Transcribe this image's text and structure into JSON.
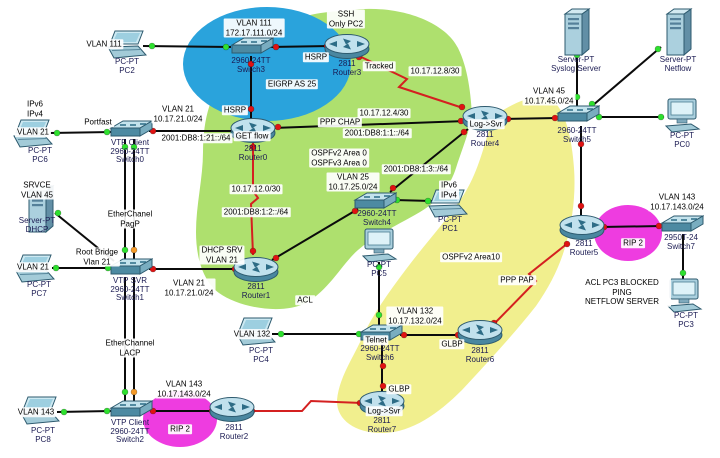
{
  "app": {
    "name": "network-topology-canvas"
  },
  "colors": {
    "black": "#0b0b0b",
    "red": "#d42020",
    "dot_green": "#2ee02e",
    "dot_red": "#e01212",
    "dot_orange": "#f59a28",
    "zone_green": "#aee06e",
    "zone_yellow": "#f1ef8e",
    "zone_blue": "#2aa3dc",
    "zone_magenta": "#ee3ce0"
  },
  "zones": [
    {
      "name": "ospf-green-region",
      "shape": "path",
      "color": "zone_green",
      "path": "M350 10 C400 4 445 22 458 48 C468 68 471 95 472 116 C468 136 461 152 456 168 C451 184 440 200 420 212 C398 225 375 235 358 250 C342 264 330 289 306 303 C282 315 240 308 219 293 C203 281 196 258 196 232 C196 205 203 178 203 152 C203 128 207 104 219 86 C231 66 258 38 290 22 C310 12 332 12 350 10 Z"
    },
    {
      "name": "ospf-area10-yellow-region",
      "shape": "path",
      "color": "zone_yellow",
      "path": "M500 112 C522 98 544 92 554 102 C566 112 572 140 574 168 C576 196 572 222 566 244 C560 266 550 286 536 306 C514 334 488 362 462 390 C438 414 412 432 384 433 C356 434 336 420 337 400 C339 378 352 360 363 336 C373 314 389 292 407 268 C425 244 447 220 463 196 C477 174 483 150 489 130 C493 118 496 114 500 112 Z"
    },
    {
      "name": "eigrp-blue-ellipse",
      "shape": "ellipse",
      "color": "zone_blue",
      "cx": 267,
      "cy": 64,
      "rx": 84,
      "ry": 57
    },
    {
      "name": "rip-magenta-ellipse-right",
      "shape": "ellipse",
      "color": "zone_magenta",
      "cx": 628,
      "cy": 233,
      "rx": 34,
      "ry": 28
    },
    {
      "name": "rip-magenta-ellipse-bottom",
      "shape": "ellipse",
      "color": "zone_magenta",
      "cx": 180,
      "cy": 419,
      "rx": 37,
      "ry": 28
    }
  ],
  "nodes": [
    {
      "id": "pc2",
      "type": "laptop",
      "x": 127,
      "y": 45,
      "ly": 58,
      "label": "PC-PT\nPC2"
    },
    {
      "id": "switch3",
      "type": "switch",
      "x": 251,
      "y": 47,
      "ly": 57,
      "label": "2960-24TT\nSwitch3"
    },
    {
      "id": "router3",
      "type": "router",
      "x": 347,
      "y": 47,
      "ly": 60,
      "label": "2811\nRouter3"
    },
    {
      "id": "syslog-server",
      "type": "server",
      "x": 576,
      "y": 32,
      "ly": 56,
      "label": "Server-PT\nSyslog Server"
    },
    {
      "id": "netflow-server",
      "type": "server",
      "x": 678,
      "y": 32,
      "ly": 56,
      "label": "Server-PT\nNetflow"
    },
    {
      "id": "pc6",
      "type": "laptop",
      "x": 33,
      "y": 134,
      "lx": 40,
      "ly": 147,
      "label": "PC-PT\nPC6"
    },
    {
      "id": "switch0",
      "type": "switch",
      "x": 130,
      "y": 130,
      "ly": 139,
      "label": "VTP Client\n2960-24TT\nSwitch0"
    },
    {
      "id": "router0",
      "type": "router",
      "x": 253,
      "y": 131,
      "ly": 145,
      "label": "2811\nRouter0"
    },
    {
      "id": "router4",
      "type": "router",
      "x": 485,
      "y": 119,
      "ly": 131,
      "label": "2811\nRouter4"
    },
    {
      "id": "switch5",
      "type": "switch",
      "x": 577,
      "y": 115,
      "ly": 127,
      "label": "2960-24TT\nSwitch5"
    },
    {
      "id": "pc0",
      "type": "desktop",
      "x": 682,
      "y": 116,
      "ly": 132,
      "label": "PC-PT\nPC0"
    },
    {
      "id": "dhcp-server",
      "type": "server",
      "x": 40,
      "y": 209,
      "lx": 37,
      "ly": 217,
      "label": "Server-PT\nDHCP"
    },
    {
      "id": "switch1",
      "type": "switch",
      "x": 130,
      "y": 268,
      "ly": 277,
      "label": "VTP SVR\n2960-24TT\nSwitch1"
    },
    {
      "id": "pc7",
      "type": "laptop",
      "x": 35,
      "y": 269,
      "lx": 39,
      "ly": 281,
      "label": "PC-PT\nPC7"
    },
    {
      "id": "router1",
      "type": "router",
      "x": 256,
      "y": 270,
      "ly": 283,
      "label": "2811\nRouter1"
    },
    {
      "id": "switch4",
      "type": "switch",
      "x": 374,
      "y": 202,
      "lx": 377,
      "ly": 210,
      "label": "2960-24TT\nSwitch4"
    },
    {
      "id": "pc1",
      "type": "laptop",
      "x": 448,
      "y": 204,
      "lx": 450,
      "ly": 216,
      "label": "PC-PT\nPC1"
    },
    {
      "id": "pc5",
      "type": "desktop",
      "x": 379,
      "y": 246,
      "ly": 261,
      "label": "PC-PT\nPC5"
    },
    {
      "id": "router5",
      "type": "router",
      "x": 582,
      "y": 228,
      "lx": 584,
      "ly": 240,
      "label": "2811\nRouter5"
    },
    {
      "id": "switch7",
      "type": "switch",
      "x": 681,
      "y": 225,
      "ly": 234,
      "label": "2950T-24\nSwitch7"
    },
    {
      "id": "pc3",
      "type": "desktop",
      "x": 684,
      "y": 296,
      "lx": 686,
      "ly": 312,
      "label": "PC-PT\nPC3"
    },
    {
      "id": "switch6",
      "type": "switch",
      "x": 380,
      "y": 334,
      "ly": 345,
      "label": "2960-24TT\nSwitch6"
    },
    {
      "id": "router6",
      "type": "router",
      "x": 480,
      "y": 333,
      "ly": 347,
      "label": "2811\nRouter6"
    },
    {
      "id": "pc4",
      "type": "laptop",
      "x": 256,
      "y": 332,
      "lx": 261,
      "ly": 347,
      "label": "PC-PT\nPC4"
    },
    {
      "id": "router7",
      "type": "router",
      "x": 382,
      "y": 404,
      "ly": 417,
      "label": "2811\nRouter7"
    },
    {
      "id": "switch2",
      "type": "switch",
      "x": 130,
      "y": 410,
      "ly": 419,
      "label": "VTP Client\n2960-24TT\nSwitch2"
    },
    {
      "id": "pc8",
      "type": "laptop",
      "x": 40,
      "y": 411,
      "lx": 43,
      "ly": 427,
      "label": "PC-PT\nPC8"
    },
    {
      "id": "router2",
      "type": "router",
      "x": 232,
      "y": 410,
      "lx": 234,
      "ly": 424,
      "label": "2811\nRouter2"
    }
  ],
  "links": [
    {
      "n": "pc2-switch3",
      "c": "black",
      "pts": [
        [
          143,
          46
        ],
        [
          231,
          47
        ]
      ]
    },
    {
      "n": "switch3-router3",
      "c": "black",
      "pts": [
        [
          269,
          47
        ],
        [
          331,
          46
        ]
      ]
    },
    {
      "n": "switch3-router0",
      "c": "black",
      "pts": [
        [
          251,
          56
        ],
        [
          251,
          121
        ]
      ]
    },
    {
      "n": "router3-router4-serial",
      "c": "red",
      "pts": [
        [
          357,
          55
        ],
        [
          407,
          79
        ],
        [
          399,
          87
        ],
        [
          463,
          108
        ]
      ]
    },
    {
      "n": "router0-router4",
      "c": "black",
      "pts": [
        [
          273,
          128
        ],
        [
          466,
          121
        ]
      ]
    },
    {
      "n": "pc6-switch0",
      "c": "black",
      "pts": [
        [
          50,
          133
        ],
        [
          112,
          132
        ]
      ]
    },
    {
      "n": "switch0-router0",
      "c": "black",
      "pts": [
        [
          149,
          131
        ],
        [
          236,
          131
        ]
      ]
    },
    {
      "n": "etherchannel-pagp-a",
      "c": "black",
      "pts": [
        [
          125,
          139
        ],
        [
          125,
          261
        ]
      ]
    },
    {
      "n": "etherchannel-pagp-b",
      "c": "black",
      "pts": [
        [
          134,
          139
        ],
        [
          134,
          261
        ]
      ]
    },
    {
      "n": "etherchannel-lacp-a",
      "c": "black",
      "pts": [
        [
          125,
          277
        ],
        [
          125,
          404
        ]
      ]
    },
    {
      "n": "etherchannel-lacp-b",
      "c": "black",
      "pts": [
        [
          134,
          277
        ],
        [
          134,
          404
        ]
      ]
    },
    {
      "n": "dhcp-switch1",
      "c": "black",
      "pts": [
        [
          55,
          213
        ],
        [
          114,
          261
        ]
      ]
    },
    {
      "n": "pc7-switch1",
      "c": "black",
      "pts": [
        [
          52,
          268
        ],
        [
          111,
          268
        ]
      ]
    },
    {
      "n": "switch1-router1",
      "c": "black",
      "pts": [
        [
          149,
          269
        ],
        [
          238,
          269
        ]
      ]
    },
    {
      "n": "router0-router1-serial",
      "c": "red",
      "pts": [
        [
          253,
          143
        ],
        [
          253,
          191
        ],
        [
          258,
          198
        ],
        [
          251,
          204
        ],
        [
          253,
          255
        ]
      ]
    },
    {
      "n": "router1-switch4",
      "c": "black",
      "pts": [
        [
          272,
          260
        ],
        [
          358,
          209
        ]
      ]
    },
    {
      "n": "switch4-router4",
      "c": "black",
      "pts": [
        [
          390,
          192
        ],
        [
          468,
          129
        ]
      ]
    },
    {
      "n": "switch4-pc1",
      "c": "black",
      "pts": [
        [
          394,
          200
        ],
        [
          432,
          201
        ]
      ]
    },
    {
      "n": "pc5-switch6",
      "c": "black",
      "pts": [
        [
          379,
          262
        ],
        [
          379,
          327
        ]
      ]
    },
    {
      "n": "pc4-switch6",
      "c": "black",
      "pts": [
        [
          272,
          334
        ],
        [
          361,
          334
        ]
      ]
    },
    {
      "n": "switch6-router6",
      "c": "black",
      "pts": [
        [
          400,
          335
        ],
        [
          462,
          335
        ]
      ]
    },
    {
      "n": "router6-router5-serial",
      "c": "red",
      "pts": [
        [
          493,
          325
        ],
        [
          536,
          281
        ],
        [
          529,
          274
        ],
        [
          568,
          243
        ]
      ]
    },
    {
      "n": "router5-switch5",
      "c": "black",
      "pts": [
        [
          581,
          217
        ],
        [
          581,
          126
        ]
      ]
    },
    {
      "n": "router4-switch5",
      "c": "black",
      "pts": [
        [
          503,
          119
        ],
        [
          558,
          118
        ]
      ]
    },
    {
      "n": "switch5-syslog",
      "c": "black",
      "pts": [
        [
          577,
          106
        ],
        [
          577,
          52
        ]
      ]
    },
    {
      "n": "switch5-netflow",
      "c": "black",
      "pts": [
        [
          592,
          106
        ],
        [
          661,
          47
        ]
      ]
    },
    {
      "n": "switch5-pc0",
      "c": "black",
      "pts": [
        [
          597,
          117
        ],
        [
          664,
          117
        ]
      ]
    },
    {
      "n": "router5-switch7",
      "c": "black",
      "pts": [
        [
          601,
          227
        ],
        [
          662,
          226
        ]
      ]
    },
    {
      "n": "switch7-pc3",
      "c": "black",
      "pts": [
        [
          683,
          234
        ],
        [
          683,
          281
        ]
      ]
    },
    {
      "n": "switch2-router2",
      "c": "black",
      "pts": [
        [
          150,
          411
        ],
        [
          215,
          411
        ]
      ]
    },
    {
      "n": "pc8-switch2",
      "c": "black",
      "pts": [
        [
          57,
          412
        ],
        [
          111,
          411
        ]
      ]
    },
    {
      "n": "router2-router7-serial",
      "c": "red",
      "pts": [
        [
          250,
          411
        ],
        [
          302,
          411
        ],
        [
          311,
          401
        ],
        [
          362,
          403
        ]
      ]
    },
    {
      "n": "switch6-router7",
      "c": "black",
      "pts": [
        [
          382,
          344
        ],
        [
          382,
          396
        ]
      ]
    }
  ],
  "dots": [
    {
      "x": 152,
      "y": 46,
      "c": "g"
    },
    {
      "x": 226,
      "y": 47,
      "c": "g"
    },
    {
      "x": 276,
      "y": 47,
      "c": "r"
    },
    {
      "x": 327,
      "y": 46,
      "c": "r"
    },
    {
      "x": 251,
      "y": 64,
      "c": "r"
    },
    {
      "x": 251,
      "y": 109,
      "c": "r"
    },
    {
      "x": 359,
      "y": 57,
      "c": "r"
    },
    {
      "x": 462,
      "y": 107,
      "c": "r"
    },
    {
      "x": 278,
      "y": 127,
      "c": "r"
    },
    {
      "x": 461,
      "y": 121,
      "c": "r"
    },
    {
      "x": 57,
      "y": 133,
      "c": "g"
    },
    {
      "x": 107,
      "y": 132,
      "c": "g"
    },
    {
      "x": 153,
      "y": 131,
      "c": "r"
    },
    {
      "x": 234,
      "y": 131,
      "c": "r"
    },
    {
      "x": 125,
      "y": 147,
      "c": "g"
    },
    {
      "x": 134,
      "y": 147,
      "c": "g"
    },
    {
      "x": 125,
      "y": 250,
      "c": "g"
    },
    {
      "x": 134,
      "y": 250,
      "c": "o"
    },
    {
      "x": 125,
      "y": 392,
      "c": "g"
    },
    {
      "x": 134,
      "y": 392,
      "c": "o"
    },
    {
      "x": 58,
      "y": 213,
      "c": "g"
    },
    {
      "x": 56,
      "y": 268,
      "c": "g"
    },
    {
      "x": 108,
      "y": 268,
      "c": "g"
    },
    {
      "x": 153,
      "y": 269,
      "c": "r"
    },
    {
      "x": 235,
      "y": 269,
      "c": "r"
    },
    {
      "x": 253,
      "y": 147,
      "c": "r"
    },
    {
      "x": 253,
      "y": 251,
      "c": "r"
    },
    {
      "x": 276,
      "y": 258,
      "c": "r"
    },
    {
      "x": 355,
      "y": 211,
      "c": "r"
    },
    {
      "x": 393,
      "y": 188,
      "c": "r"
    },
    {
      "x": 464,
      "y": 132,
      "c": "r"
    },
    {
      "x": 397,
      "y": 200,
      "c": "g"
    },
    {
      "x": 428,
      "y": 201,
      "c": "g"
    },
    {
      "x": 379,
      "y": 267,
      "c": "g"
    },
    {
      "x": 379,
      "y": 315,
      "c": "g"
    },
    {
      "x": 281,
      "y": 334,
      "c": "g"
    },
    {
      "x": 359,
      "y": 334,
      "c": "g"
    },
    {
      "x": 404,
      "y": 335,
      "c": "r"
    },
    {
      "x": 458,
      "y": 335,
      "c": "r"
    },
    {
      "x": 494,
      "y": 323,
      "c": "r"
    },
    {
      "x": 567,
      "y": 244,
      "c": "r"
    },
    {
      "x": 581,
      "y": 206,
      "c": "r"
    },
    {
      "x": 581,
      "y": 144,
      "c": "r"
    },
    {
      "x": 508,
      "y": 119,
      "c": "r"
    },
    {
      "x": 555,
      "y": 118,
      "c": "r"
    },
    {
      "x": 577,
      "y": 97,
      "c": "g"
    },
    {
      "x": 577,
      "y": 55,
      "c": "g"
    },
    {
      "x": 592,
      "y": 104,
      "c": "g"
    },
    {
      "x": 658,
      "y": 49,
      "c": "g"
    },
    {
      "x": 599,
      "y": 117,
      "c": "g"
    },
    {
      "x": 661,
      "y": 117,
      "c": "g"
    },
    {
      "x": 604,
      "y": 227,
      "c": "r"
    },
    {
      "x": 659,
      "y": 226,
      "c": "r"
    },
    {
      "x": 683,
      "y": 273,
      "c": "g"
    },
    {
      "x": 153,
      "y": 411,
      "c": "r"
    },
    {
      "x": 212,
      "y": 411,
      "c": "r"
    },
    {
      "x": 64,
      "y": 412,
      "c": "g"
    },
    {
      "x": 107,
      "y": 411,
      "c": "g"
    },
    {
      "x": 252,
      "y": 411,
      "c": "r"
    },
    {
      "x": 360,
      "y": 403,
      "c": "r"
    },
    {
      "x": 383,
      "y": 366,
      "c": "r"
    },
    {
      "x": 383,
      "y": 386,
      "c": "r"
    }
  ],
  "notes": [
    {
      "t": "VLAN 111",
      "x": 104,
      "y": 44
    },
    {
      "t": "VLAN 111\n172.17.111.0/24",
      "x": 254,
      "y": 28
    },
    {
      "t": "SSH\nOnly PC2",
      "x": 346,
      "y": 19
    },
    {
      "t": "HSRP",
      "x": 316,
      "y": 57
    },
    {
      "t": "Tracked",
      "x": 379,
      "y": 66
    },
    {
      "t": "10.17.12.8/30",
      "x": 435,
      "y": 71
    },
    {
      "t": "EIGRP AS 25",
      "x": 292,
      "y": 84
    },
    {
      "t": "HSRP",
      "x": 235,
      "y": 110
    },
    {
      "t": "VLAN 21\n10.17.21.0/24",
      "x": 178,
      "y": 114
    },
    {
      "t": "2001:DB8:1:21::/64",
      "x": 196,
      "y": 138
    },
    {
      "t": "GET flow",
      "x": 252,
      "y": 136
    },
    {
      "t": "PPP CHAP",
      "x": 340,
      "y": 122
    },
    {
      "t": "10.17.12.4/30",
      "x": 384,
      "y": 113
    },
    {
      "t": "2001:DB8:1:1::/64",
      "x": 377,
      "y": 133
    },
    {
      "t": "Log->Svr",
      "x": 486,
      "y": 124
    },
    {
      "t": "VLAN 45\n10.17.45.0/24",
      "x": 549,
      "y": 96
    },
    {
      "t": "IPv6\nIPv4",
      "x": 35,
      "y": 109
    },
    {
      "t": "VLAN 21",
      "x": 33,
      "y": 132
    },
    {
      "t": "Portfast",
      "x": 98,
      "y": 122
    },
    {
      "t": "SRVCE\nVLAN 45",
      "x": 37,
      "y": 190
    },
    {
      "t": "EtherChanel\nPagP",
      "x": 130,
      "y": 219
    },
    {
      "t": "Root Bridge\nVlan 21",
      "x": 97,
      "y": 257
    },
    {
      "t": "VLAN 21",
      "x": 33,
      "y": 267
    },
    {
      "t": "OSPFv2 Area 0\nOSPFv3 Area 0",
      "x": 339,
      "y": 158
    },
    {
      "t": "VLAN 25\n10.17.25.0/24",
      "x": 353,
      "y": 182
    },
    {
      "t": "2001:DB8:1:3::/64",
      "x": 416,
      "y": 169
    },
    {
      "t": "IPv6\nIPv4",
      "x": 449,
      "y": 190
    },
    {
      "t": "10.17.12.0/30",
      "x": 256,
      "y": 189
    },
    {
      "t": "2001:DB8:1:2::/64",
      "x": 256,
      "y": 212
    },
    {
      "t": "DHCP SRV\nVLAN 21",
      "x": 222,
      "y": 255
    },
    {
      "t": "VLAN 21\n10.17.21.0/24",
      "x": 189,
      "y": 288
    },
    {
      "t": "ACL",
      "x": 305,
      "y": 300
    },
    {
      "t": "OSPFv2 Area10",
      "x": 471,
      "y": 257
    },
    {
      "t": "PPP PAP",
      "x": 517,
      "y": 280
    },
    {
      "t": "VLAN 143\n10.17.143.0/24",
      "x": 677,
      "y": 202
    },
    {
      "t": "RIP 2",
      "x": 633,
      "y": 243
    },
    {
      "t": "ACL PC3 BLOCKED PING\nNETFLOW SERVER",
      "x": 622,
      "y": 292
    },
    {
      "t": "VLAN 132\n10.17.132.0/24",
      "x": 415,
      "y": 316
    },
    {
      "t": "Telnet",
      "x": 376,
      "y": 340
    },
    {
      "t": "GLBP",
      "x": 452,
      "y": 344
    },
    {
      "t": "GLBP",
      "x": 399,
      "y": 389
    },
    {
      "t": "Log->Svr",
      "x": 384,
      "y": 411
    },
    {
      "t": "VLAN 132",
      "x": 252,
      "y": 334
    },
    {
      "t": "EtherChannel\nLACP",
      "x": 130,
      "y": 348
    },
    {
      "t": "VLAN 143\n10.17.143.0/24",
      "x": 184,
      "y": 389
    },
    {
      "t": "RIP 2",
      "x": 180,
      "y": 429
    },
    {
      "t": "VLAN 143",
      "x": 36,
      "y": 412
    }
  ]
}
